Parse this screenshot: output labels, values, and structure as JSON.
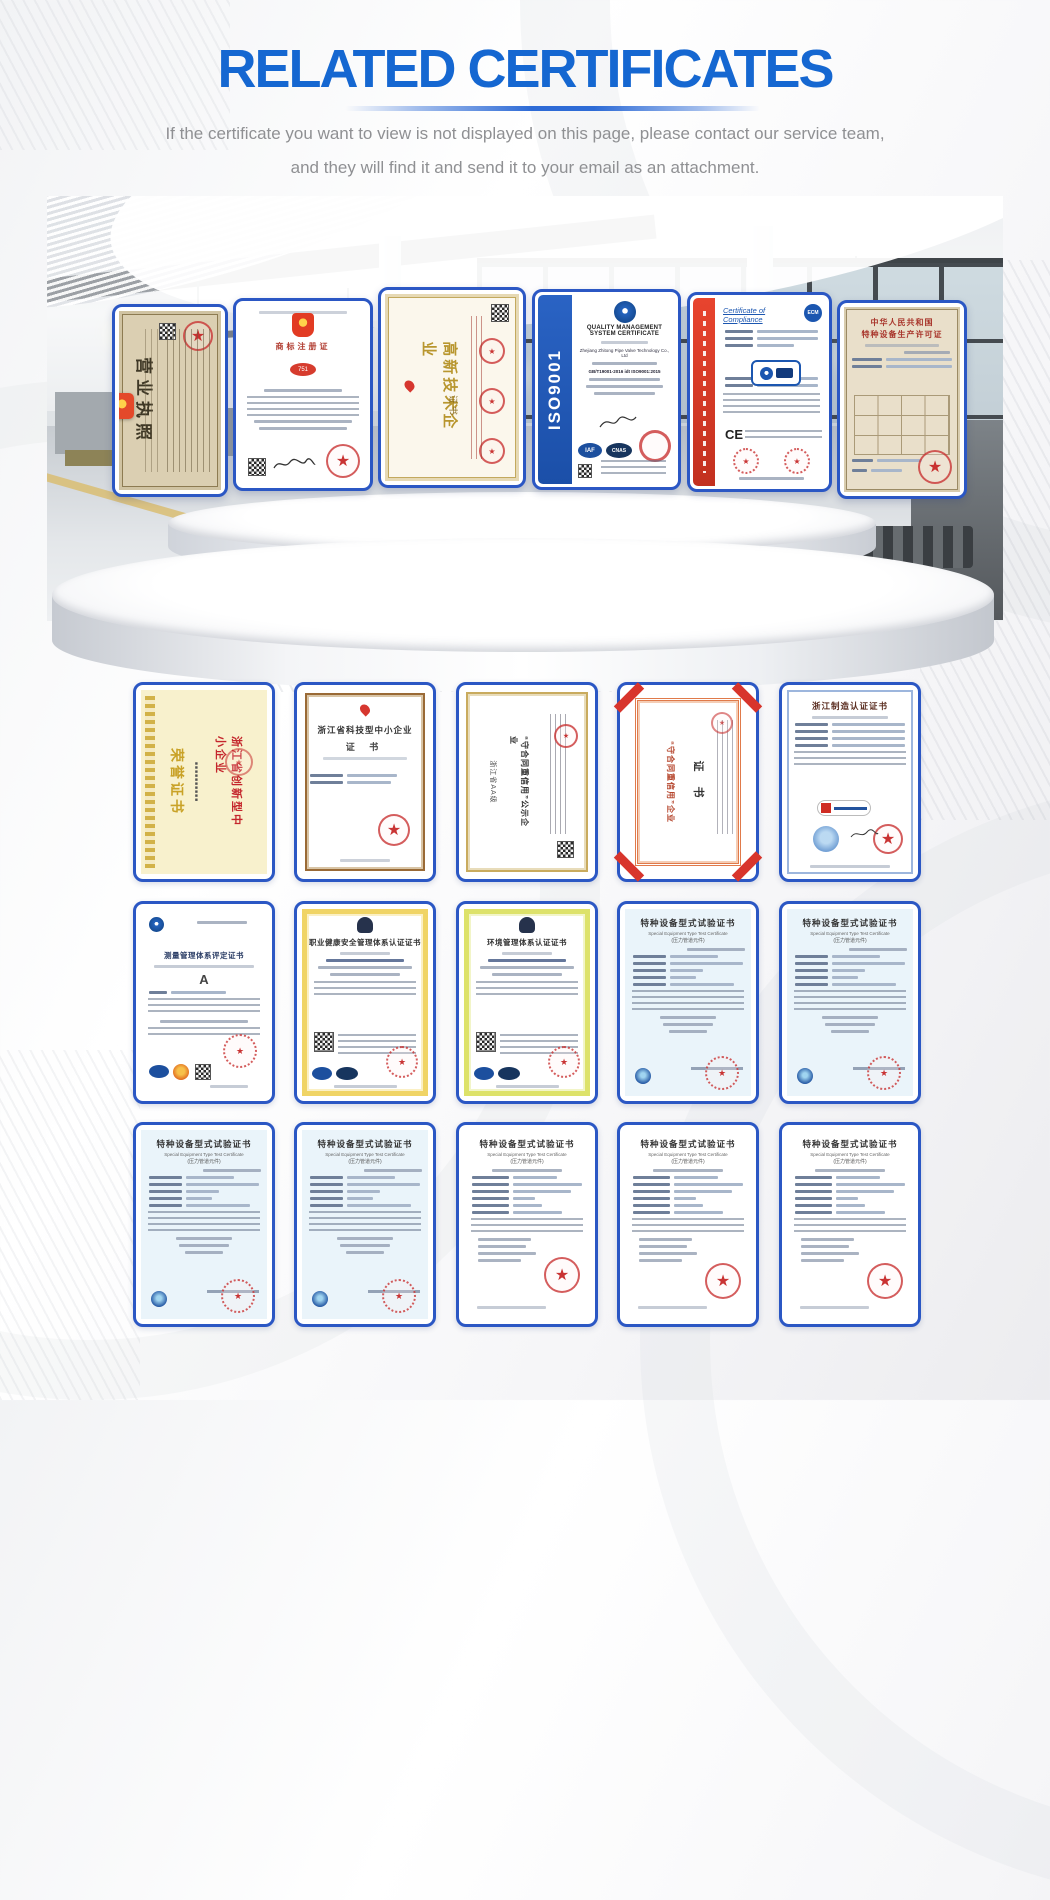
{
  "header": {
    "title": "RELATED CERTIFICATES",
    "subtitle1": "If the certificate you want to view is not displayed on this page, please contact our service team,",
    "subtitle2": "and they will find it and send it to your email as an attachment."
  },
  "colors": {
    "accent_blue": "#1567d1",
    "card_border_blue": "#2b57c4",
    "seal_red": "#c62828"
  },
  "stage": {
    "certs": [
      {
        "id": "business-license",
        "vertical_title": "营业执照"
      },
      {
        "id": "trademark-registration",
        "title": "商标注册证"
      },
      {
        "id": "high-tech-enterprise",
        "vertical_title": "高新技术企业",
        "vertical_subtitle": "证书"
      },
      {
        "id": "iso9001",
        "side_label": "ISO9001",
        "title": "QUALITY MANAGEMENT SYSTEM CERTIFICATE",
        "holder": "Zhejiang Zhitong Pipe Valve Technology Co., Ltd",
        "standard": "GB/T19001-2016 idt ISO9001:2015",
        "seal1": "IAF",
        "seal2": "CNAS"
      },
      {
        "id": "certificate-of-compliance",
        "title": "Certificate of Compliance",
        "logo_label": "ECM",
        "ce": "CE"
      },
      {
        "id": "special-equipment-license",
        "title1": "中华人民共和国",
        "title2": "特种设备生产许可证"
      }
    ]
  },
  "grid": {
    "rows": [
      {
        "cards": [
          {
            "id": "honor-certificate",
            "script_title": "荣誉证书",
            "red_title": "浙江省创新型中小企业"
          },
          {
            "id": "tech-sme-certificate",
            "title": "浙江省科技型中小企业",
            "subtitle": "证 书"
          },
          {
            "id": "contract-credit-public",
            "line_pre": "浙江省AA级",
            "line_main": "“守合同重信用”公示企业"
          },
          {
            "id": "contract-credit-cert",
            "line_main": "“守合同重信用”企业",
            "subtitle": "证 书"
          },
          {
            "id": "zhejiang-made-cert",
            "title": "浙江制造认证证书"
          }
        ]
      },
      {
        "cards": [
          {
            "id": "measurement-system-cert",
            "title": "测量管理体系评定证书",
            "grade": "A"
          },
          {
            "id": "ohs-management-cert",
            "title": "职业健康安全管理体系认证证书"
          },
          {
            "id": "environment-management-cert",
            "title": "环境管理体系认证证书"
          },
          {
            "id": "type-test-cert-1",
            "title": "特种设备型式试验证书",
            "en": "Special Equipment Type Test Certificate",
            "paren": "(压力管道元件)"
          },
          {
            "id": "type-test-cert-2",
            "title": "特种设备型式试验证书",
            "en": "Special Equipment Type Test Certificate",
            "paren": "(压力管道元件)"
          }
        ]
      },
      {
        "cards": [
          {
            "id": "type-test-cert-3",
            "title": "特种设备型式试验证书",
            "en": "Special Equipment Type Test Certificate",
            "paren": "(压力管道元件)"
          },
          {
            "id": "type-test-cert-4",
            "title": "特种设备型式试验证书",
            "en": "Special Equipment Type Test Certificate",
            "paren": "(压力管道元件)"
          },
          {
            "id": "type-test-cert-5",
            "title": "特种设备型式试验证书",
            "en": "Special Equipment Type Test Certificate",
            "paren": "(压力管道元件)"
          },
          {
            "id": "type-test-cert-6",
            "title": "特种设备型式试验证书",
            "en": "Special Equipment Type Test Certificate",
            "paren": "(压力管道元件)"
          },
          {
            "id": "type-test-cert-7",
            "title": "特种设备型式试验证书",
            "en": "Special Equipment Type Test Certificate",
            "paren": "(压力管道元件)"
          }
        ]
      }
    ]
  }
}
